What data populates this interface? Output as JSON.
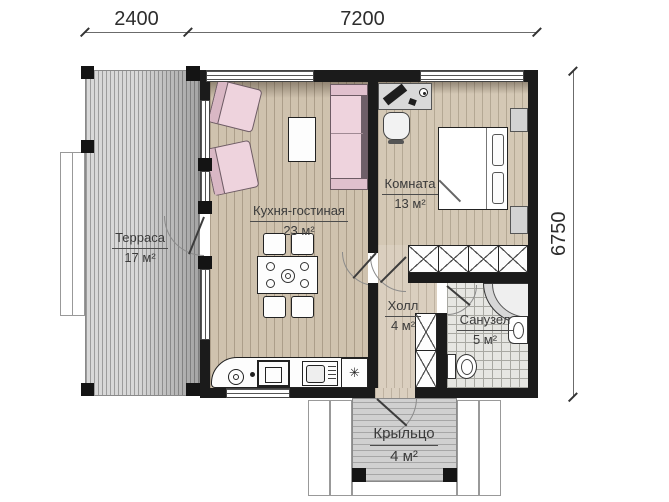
{
  "dimensions": {
    "terrace_width": "2400",
    "house_width": "7200",
    "house_depth": "6750"
  },
  "rooms": {
    "terrace": {
      "name": "Терраса",
      "area": "17 м²"
    },
    "kitchen_living": {
      "name": "Кухня-гостиная",
      "area": "23 м²"
    },
    "bedroom": {
      "name": "Комната",
      "area": "13 м²"
    },
    "hall": {
      "name": "Холл",
      "area": "4 м²"
    },
    "bathroom": {
      "name": "Санузел",
      "area": "5 м²"
    },
    "porch": {
      "name": "Крыльцо",
      "area": "4 м²"
    }
  },
  "icons": {
    "washer_symbol": "✳"
  },
  "colors": {
    "wall": "#1b1b1b",
    "wood_floor": "#cfc2ae",
    "terrace_deck": "#d8d8d8",
    "tile_floor": "#e6e6e2",
    "furniture_pink": "#eed3dd",
    "counter_white": "#ffffff"
  }
}
